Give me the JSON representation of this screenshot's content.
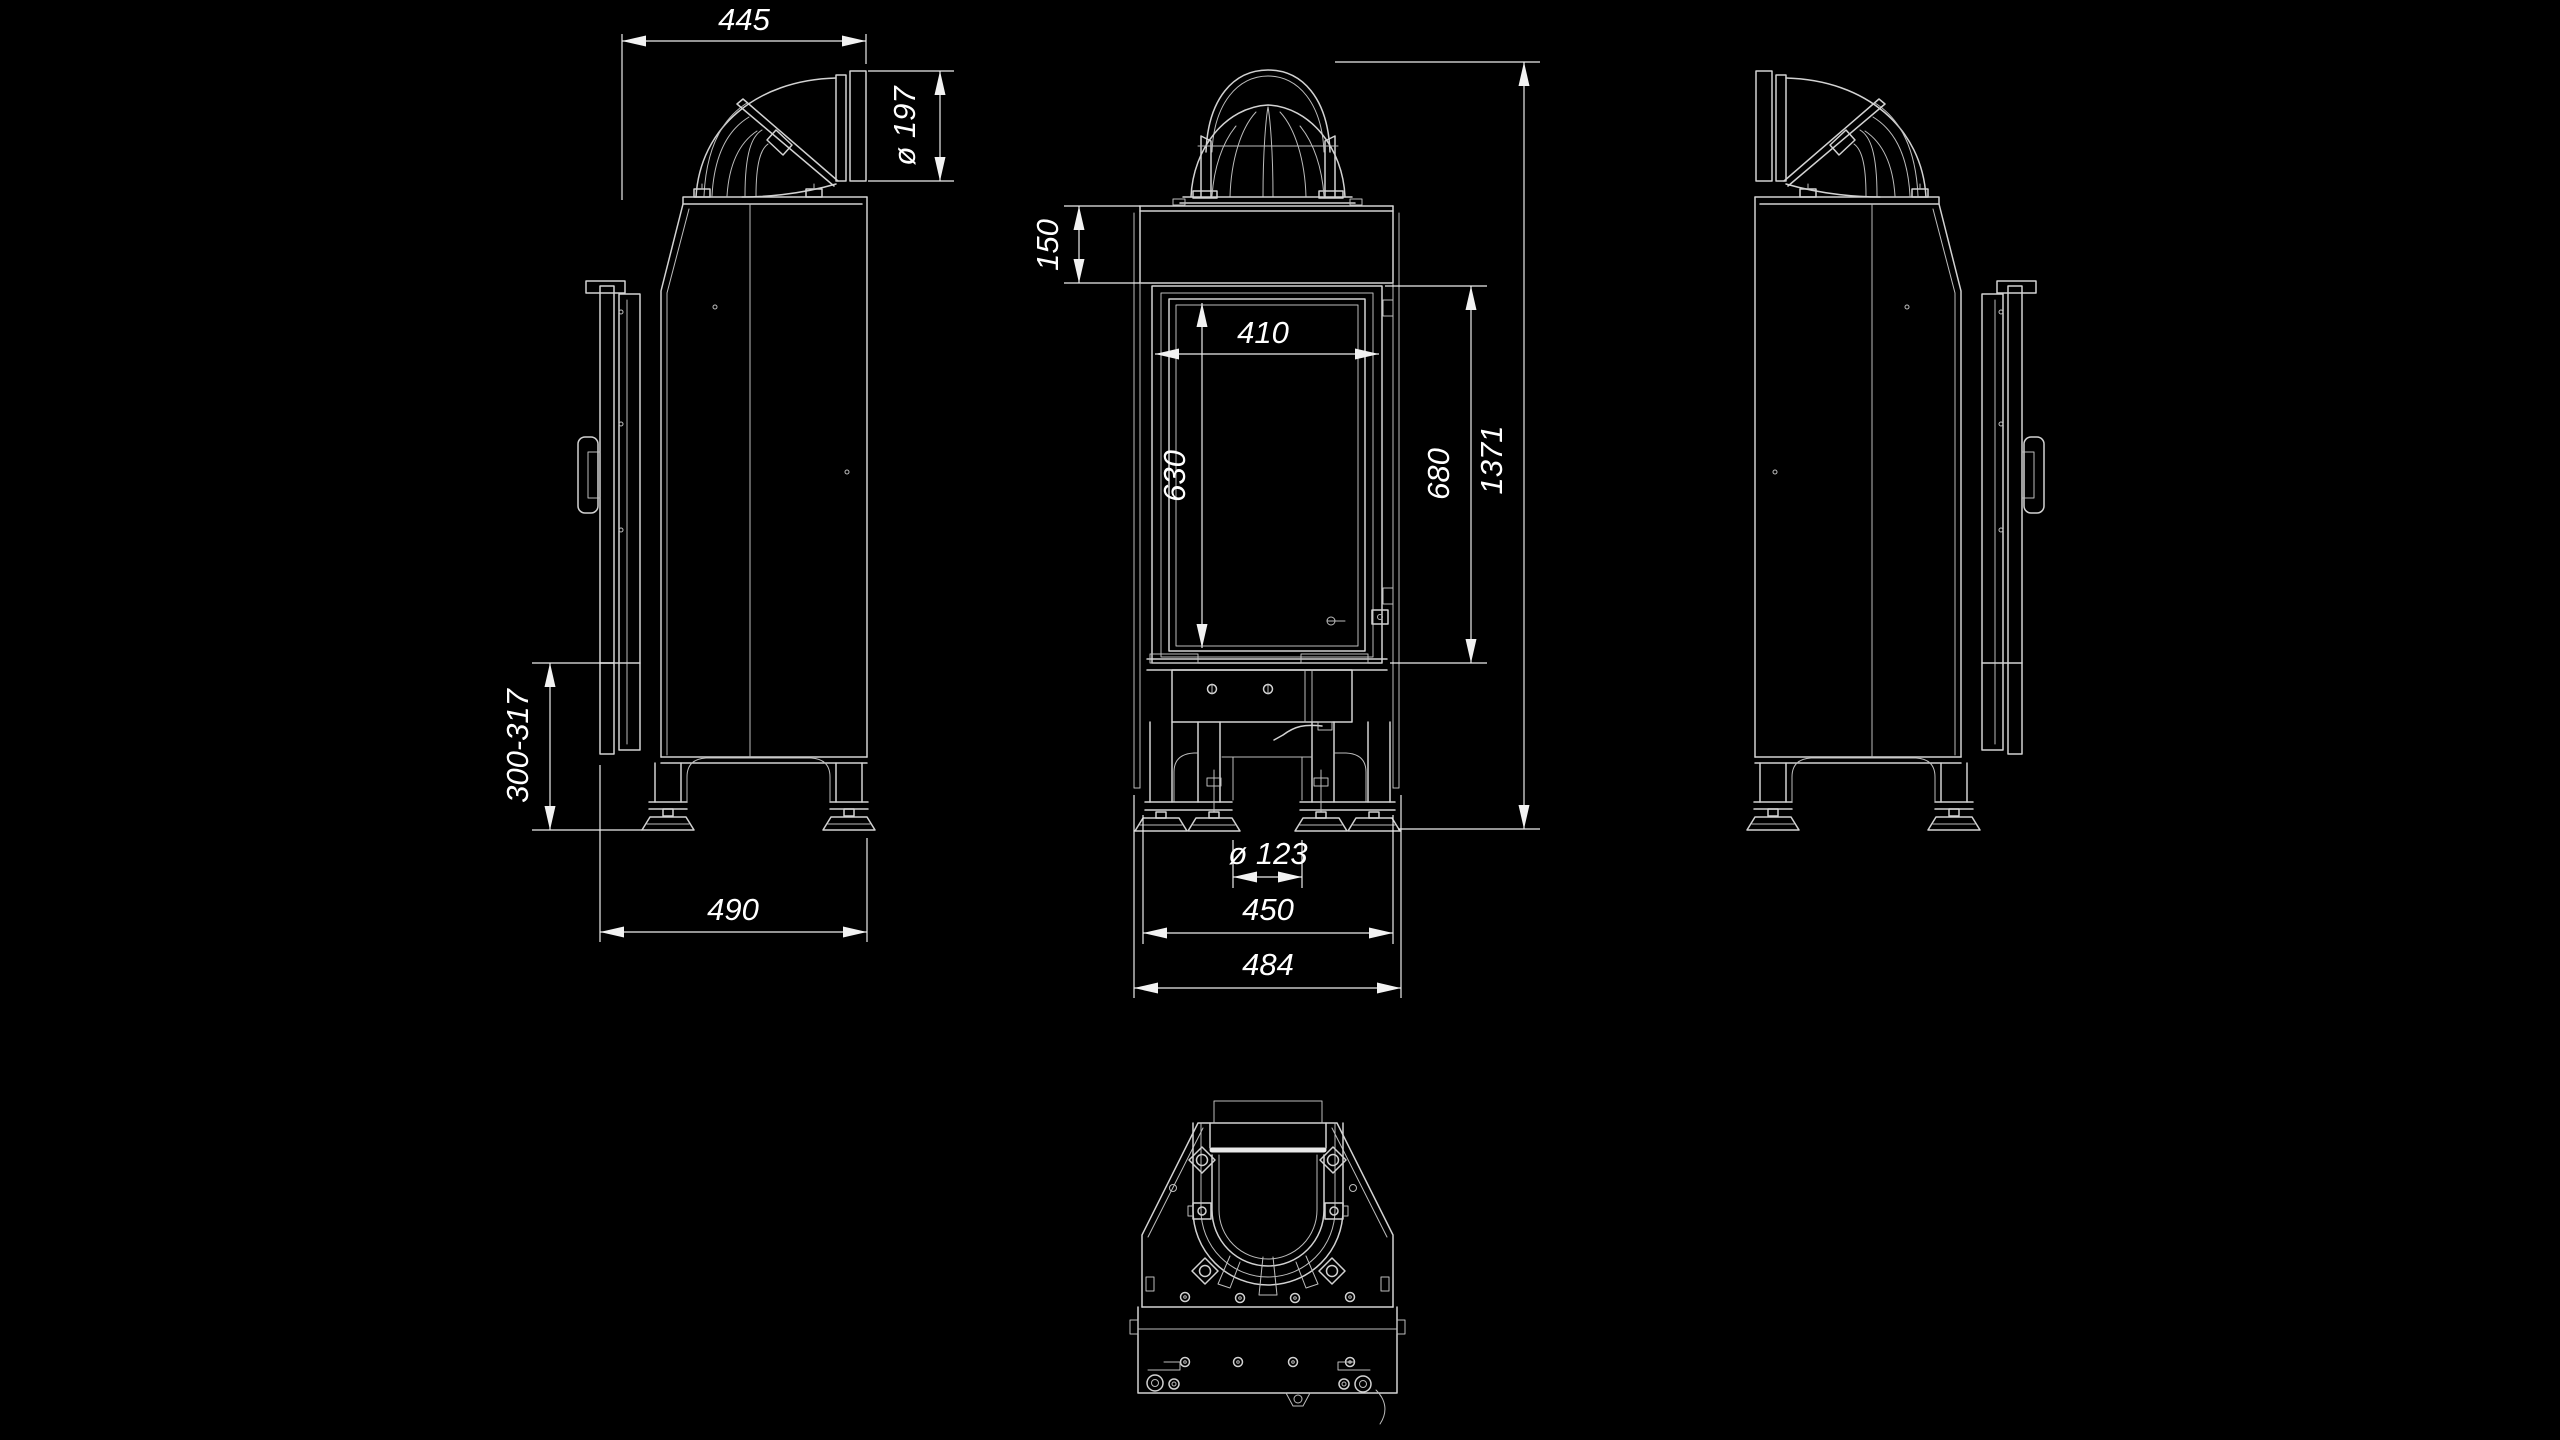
{
  "canvas": {
    "background_color": "#000000",
    "line_color": "#d2d2d2",
    "dimension_line_color": "#ececec",
    "text_color": "#ffffff"
  },
  "dimensions": {
    "side_view": {
      "flue_top_width": "445",
      "flue_diameter": "ø 197",
      "adjustable_base_height": "300-317",
      "depth": "490"
    },
    "front_view": {
      "collar_band_height": "150",
      "glass_width": "410",
      "glass_height": "630",
      "door_height": "680",
      "overall_height": "1371",
      "air_inlet_diameter": "ø 123",
      "base_width": "450",
      "overall_width": "484"
    }
  }
}
